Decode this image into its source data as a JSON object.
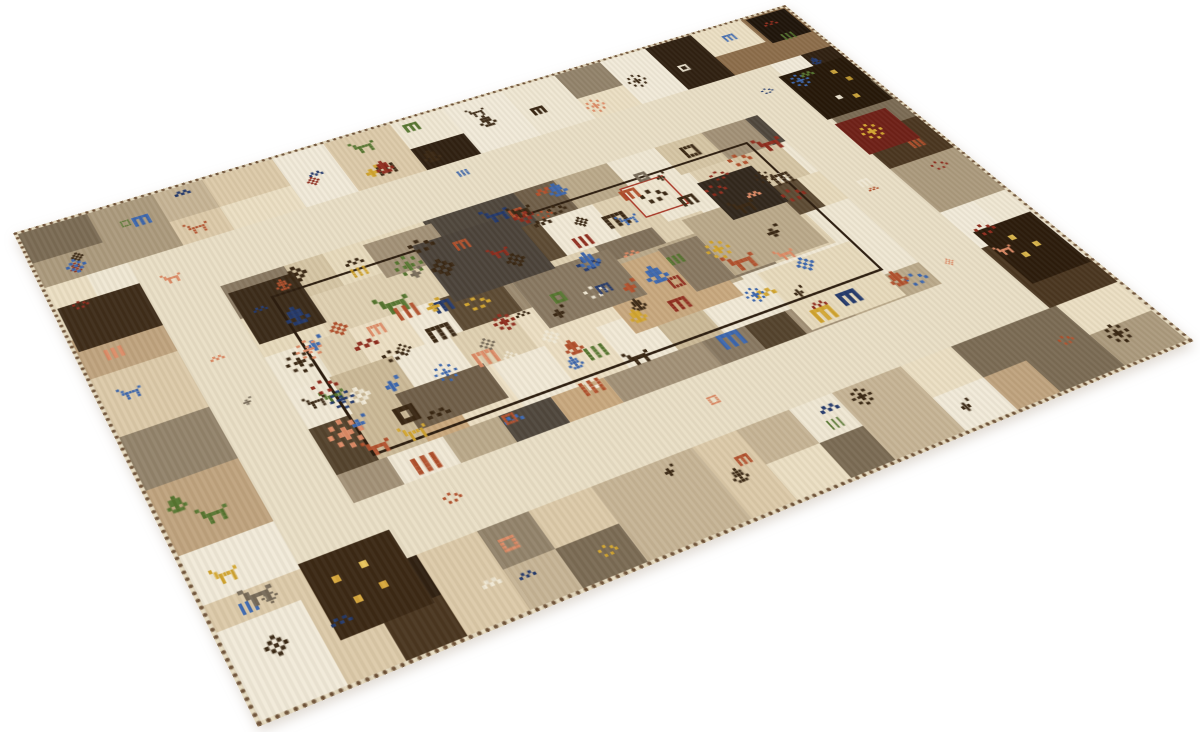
{
  "scene": {
    "type": "product-photo",
    "subject": "Hand-knotted wool patchwork Gabbeh-style rug with tribal motifs, photographed at a perspective angle on a seamless white background",
    "background_color": "#ffffff"
  },
  "rug": {
    "flat_width": 1000,
    "flat_height": 640,
    "corners": {
      "left": [
        13,
        233
      ],
      "top": [
        785,
        5
      ],
      "right": [
        1194,
        341
      ],
      "bottom": [
        258,
        727
      ]
    },
    "seed": 20,
    "edge": {
      "stitch_color": "#6b4e33",
      "base_color": "#e7dcc2"
    },
    "layout": {
      "border_thickness": 90,
      "band_start": 94,
      "band_thickness": 73,
      "band_color": "#e9dfc6",
      "field": [
        167,
        167,
        833,
        473
      ],
      "outline_rect": [
        207,
        202,
        793,
        432
      ],
      "outline_color": "#2b1c0e"
    },
    "palettes": {
      "border": [
        {
          "c": "#ebdfc3",
          "w": 2.6
        },
        {
          "c": "#dccaa9",
          "w": 1.8
        },
        {
          "c": "#c6b495",
          "w": 1.8
        },
        {
          "c": "#ab9a7d",
          "w": 1.8
        },
        {
          "c": "#92836b",
          "w": 1.8
        },
        {
          "c": "#7a6b54",
          "w": 1.5
        },
        {
          "c": "#62513a",
          "w": 1.3
        },
        {
          "c": "#8c6d4a",
          "w": 1.1
        },
        {
          "c": "#49351f",
          "w": 1.1
        },
        {
          "c": "#2e1f10",
          "w": 0.9
        },
        {
          "c": "#f1ead9",
          "w": 1.2
        },
        {
          "c": "#bfa37e",
          "w": 1.2
        }
      ],
      "field_outer": [
        {
          "c": "#e7dabc",
          "w": 2.2
        },
        {
          "c": "#d5c5a4",
          "w": 1.8
        },
        {
          "c": "#baa98a",
          "w": 2.0
        },
        {
          "c": "#a29177",
          "w": 2.0
        },
        {
          "c": "#887861",
          "w": 1.8
        },
        {
          "c": "#6f5e48",
          "w": 1.4
        },
        {
          "c": "#53422c",
          "w": 1.0
        },
        {
          "c": "#3a2a18",
          "w": 0.8
        },
        {
          "c": "#4e463c",
          "w": 0.9
        },
        {
          "c": "#c8a87e",
          "w": 1.0
        },
        {
          "c": "#f0e8d5",
          "w": 1.2
        }
      ],
      "field_inner": [
        {
          "c": "#ecdfc3",
          "w": 3.2
        },
        {
          "c": "#f1e9d6",
          "w": 2.2
        },
        {
          "c": "#dfd0b1",
          "w": 2.0
        },
        {
          "c": "#cbb997",
          "w": 1.7
        },
        {
          "c": "#b3a284",
          "w": 1.4
        },
        {
          "c": "#9c8b71",
          "w": 1.0
        },
        {
          "c": "#80705a",
          "w": 0.7
        },
        {
          "c": "#5c4a33",
          "w": 0.5
        },
        {
          "c": "#caa87c",
          "w": 0.9
        },
        {
          "c": "#42321f",
          "w": 0.4
        }
      ],
      "motif_colors": [
        {
          "c": "#382612",
          "w": 2.2
        },
        {
          "c": "#b1502c",
          "w": 1.4
        },
        {
          "c": "#8e2b1c",
          "w": 1.0
        },
        {
          "c": "#3b66ae",
          "w": 1.3
        },
        {
          "c": "#22386b",
          "w": 0.8
        },
        {
          "c": "#dd8b66",
          "w": 0.8
        },
        {
          "c": "#f0e8d4",
          "w": 0.7
        },
        {
          "c": "#55752f",
          "w": 0.6
        },
        {
          "c": "#d2a52f",
          "w": 0.5
        },
        {
          "c": "#766a58",
          "w": 0.6
        }
      ]
    },
    "motif_shapes": {
      "tree": [
        [
          0,
          0
        ],
        [
          0,
          -2
        ],
        [
          0,
          -1
        ],
        [
          0,
          1
        ],
        [
          0,
          2
        ],
        [
          -1,
          -1
        ],
        [
          1,
          -1
        ],
        [
          -1,
          0
        ],
        [
          1,
          0
        ],
        [
          -2,
          1
        ],
        [
          2,
          1
        ],
        [
          -1,
          2
        ],
        [
          1,
          2
        ]
      ],
      "animal": [
        [
          0,
          0
        ],
        [
          1,
          0
        ],
        [
          2,
          0
        ],
        [
          3,
          0
        ],
        [
          0,
          1
        ],
        [
          3,
          1
        ],
        [
          0,
          2
        ],
        [
          3,
          2
        ],
        [
          -1,
          0
        ],
        [
          -1,
          -1
        ],
        [
          -2,
          -2
        ],
        [
          4,
          -1
        ]
      ],
      "flower": [
        [
          0,
          0
        ],
        [
          0,
          -2
        ],
        [
          0,
          2
        ],
        [
          -2,
          0
        ],
        [
          2,
          0
        ],
        [
          -1,
          -1
        ],
        [
          1,
          -1
        ],
        [
          -1,
          1
        ],
        [
          1,
          1
        ]
      ],
      "star": [
        [
          0,
          0
        ],
        [
          0,
          -1
        ],
        [
          0,
          1
        ],
        [
          -1,
          0
        ],
        [
          1,
          0
        ],
        [
          0,
          -3
        ],
        [
          0,
          3
        ],
        [
          -3,
          0
        ],
        [
          3,
          0
        ],
        [
          -2,
          -2
        ],
        [
          2,
          -2
        ],
        [
          -2,
          2
        ],
        [
          2,
          2
        ]
      ],
      "comb": [
        [
          0,
          0
        ],
        [
          1,
          0
        ],
        [
          2,
          0
        ],
        [
          3,
          0
        ],
        [
          4,
          0
        ],
        [
          0,
          1
        ],
        [
          2,
          1
        ],
        [
          4,
          1
        ],
        [
          0,
          2
        ],
        [
          2,
          2
        ],
        [
          4,
          2
        ],
        [
          0,
          3
        ],
        [
          2,
          3
        ],
        [
          4,
          3
        ]
      ],
      "sq": [
        [
          0,
          0
        ],
        [
          1,
          0
        ],
        [
          2,
          0
        ],
        [
          3,
          0
        ],
        [
          0,
          1
        ],
        [
          3,
          1
        ],
        [
          0,
          2
        ],
        [
          3,
          2
        ],
        [
          0,
          3
        ],
        [
          1,
          3
        ],
        [
          2,
          3
        ],
        [
          3,
          3
        ]
      ],
      "bars": [
        [
          0,
          0
        ],
        [
          0,
          1
        ],
        [
          0,
          2
        ],
        [
          0,
          3
        ],
        [
          2,
          0
        ],
        [
          2,
          1
        ],
        [
          2,
          2
        ],
        [
          2,
          3
        ],
        [
          4,
          0
        ],
        [
          4,
          1
        ],
        [
          4,
          2
        ],
        [
          4,
          3
        ]
      ],
      "bird": [
        [
          0,
          0
        ],
        [
          1,
          0
        ],
        [
          2,
          0
        ],
        [
          1,
          -1
        ],
        [
          3,
          -2
        ],
        [
          1,
          1
        ]
      ],
      "zig": [
        [
          0,
          0
        ],
        [
          1,
          -1
        ],
        [
          2,
          0
        ],
        [
          3,
          -1
        ],
        [
          4,
          0
        ]
      ],
      "dots": [
        [
          0,
          0
        ],
        [
          2,
          -1
        ],
        [
          4,
          0
        ],
        [
          1,
          2
        ],
        [
          3,
          2
        ],
        [
          5,
          1
        ]
      ]
    },
    "counts": {
      "field_motifs": 112,
      "border_motifs": 56,
      "band_motifs": 10,
      "big_patches": 9
    },
    "features": [
      {
        "name": "dark-square-top-corner",
        "x": 936,
        "y": 6,
        "w": 58,
        "h": 54,
        "color": "#1d1309",
        "dots": []
      },
      {
        "name": "dark-square-right-border-upper",
        "x": 900,
        "y": 118,
        "w": 94,
        "h": 90,
        "color": "#241607",
        "dots": [
          [
            62,
            16,
            "#c9a23a"
          ],
          [
            70,
            34,
            "#b8922e"
          ],
          [
            36,
            58,
            "#e9e1cd"
          ],
          [
            56,
            64,
            "#c9a23a"
          ]
        ]
      },
      {
        "name": "maroon-star-patch",
        "x": 902,
        "y": 218,
        "w": 72,
        "h": 60,
        "color": "#6e1f16",
        "motif": {
          "type": "star",
          "color": "#d2a52f",
          "s": 4
        },
        "dots": []
      },
      {
        "name": "dark-square-right-border-lower",
        "x": 916,
        "y": 426,
        "w": 78,
        "h": 86,
        "color": "#2a1a0a",
        "dots": [
          [
            28,
            20,
            "#d8b44a"
          ],
          [
            44,
            38,
            "#d8b44a"
          ],
          [
            22,
            46,
            "#d8b44a"
          ]
        ]
      },
      {
        "name": "dark-square-bottom-left",
        "x": 94,
        "y": 512,
        "w": 88,
        "h": 84,
        "color": "#3a2713",
        "dots": [
          [
            20,
            24,
            "#d8a83c"
          ],
          [
            48,
            20,
            "#e8c45c"
          ],
          [
            28,
            50,
            "#d8a83c"
          ],
          [
            54,
            46,
            "#d8a83c"
          ]
        ]
      },
      {
        "name": "red-outlined-square",
        "x": 618,
        "y": 210,
        "w": 56,
        "h": 52,
        "color": "#efe6d0",
        "outline": "#a83524",
        "speckle": true,
        "dots": []
      },
      {
        "name": "slate-patch",
        "x": 372,
        "y": 196,
        "w": 118,
        "h": 92,
        "color": "#4a4239",
        "streak": true,
        "dots": []
      },
      {
        "name": "chocolate-patch-field",
        "x": 700,
        "y": 238,
        "w": 72,
        "h": 66,
        "color": "#30261b",
        "streak": true,
        "dots": []
      },
      {
        "name": "brown-patch-left-border",
        "x": 6,
        "y": 128,
        "w": 88,
        "h": 66,
        "color": "#3d2b18",
        "streak": true,
        "dots": []
      }
    ]
  }
}
